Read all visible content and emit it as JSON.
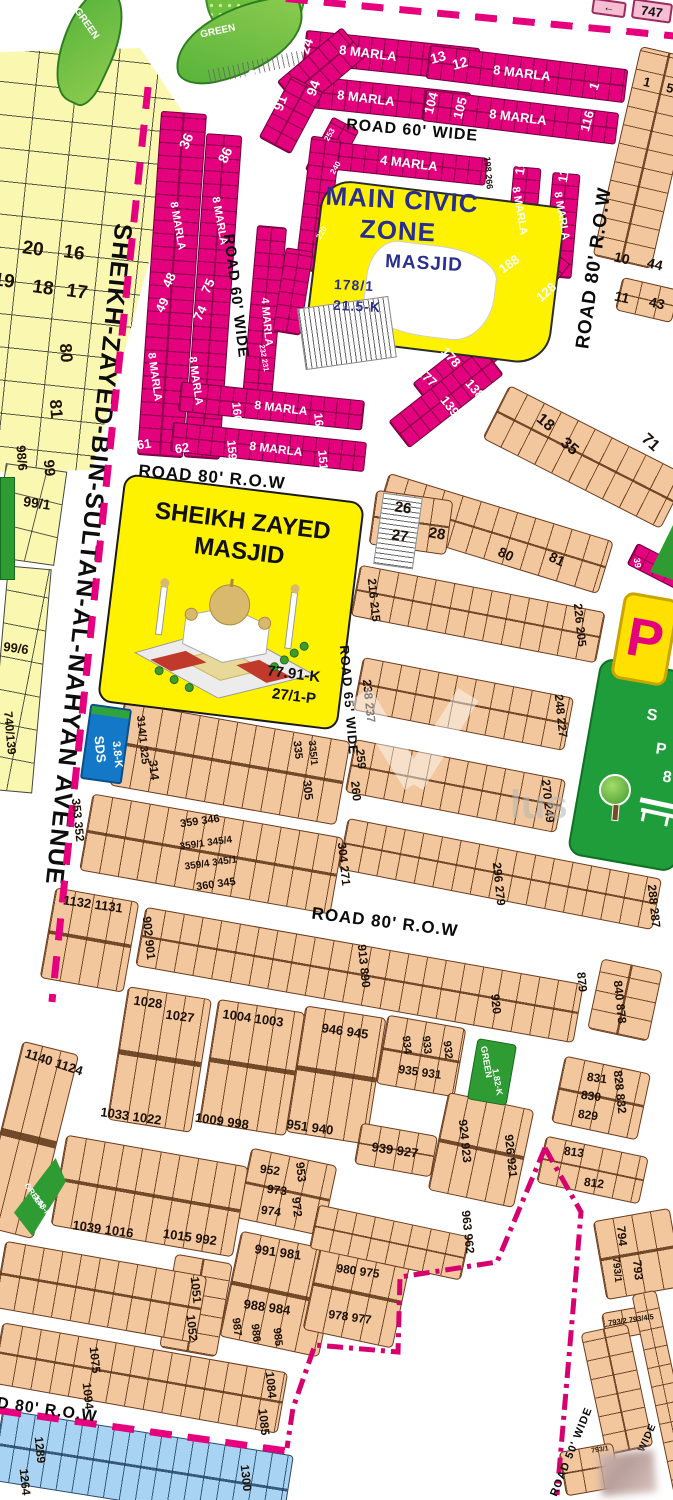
{
  "avenue": {
    "name": "SHEIKH-ZAYED-BIN-SULTAN-AL-NAHYAN AVENUE"
  },
  "civic_zone": {
    "line1": "MAIN CIVIC",
    "line2": "ZONE",
    "line3": "MASJID",
    "plot_no": "178/1",
    "area": "21.5-K"
  },
  "masjid_panel": {
    "line1": "SHEIKH ZAYED",
    "line2": "MASJID",
    "area": "77.91-K",
    "plot_no": "27/1-P"
  },
  "sds_box": {
    "name": "SDS",
    "area": "3.8-K"
  },
  "park": {
    "sign": "P"
  },
  "corner_boxes": {
    "box_747": "747",
    "arrow": "←"
  },
  "watermark": "lus",
  "colors": {
    "magenta": "#E4017D",
    "tan": "#F2C79E",
    "yellow": "#FAF8B0",
    "park_green": "#1F9D3A",
    "blue_strip": "#A9D3F2",
    "dash_pink": "#E6007E",
    "civic_blue": "#2A2F8F",
    "sds_blue": "#1478C8"
  },
  "road_labels": [
    [
      "ROAD 60' WIDE",
      412,
      131,
      5,
      16
    ],
    [
      "ROAD 60' WIDE",
      236,
      296,
      83,
      15
    ],
    [
      "ROAD 80' R.O.W",
      212,
      477,
      5,
      17
    ],
    [
      "ROAD 80' R.O.W",
      594,
      268,
      -82,
      19
    ],
    [
      "ROAD 65' WIDE",
      349,
      700,
      85,
      13
    ],
    [
      "ROAD 80' R.O.W",
      385,
      922,
      7,
      17
    ],
    [
      "ROAD 80' R.O.W",
      28,
      1408,
      8,
      16
    ],
    [
      "ROAD 50' WIDE",
      572,
      1452,
      -68,
      11
    ],
    [
      "WIDE",
      648,
      1438,
      -65,
      10
    ]
  ],
  "plot_labels": [
    [
      "24",
      306,
      46,
      -70,
      14,
      "w"
    ],
    [
      "29",
      252,
      77,
      -70,
      14,
      "w"
    ],
    [
      "30",
      228,
      92,
      -70,
      14,
      "w"
    ],
    [
      "91",
      280,
      103,
      -70,
      14,
      "w"
    ],
    [
      "94",
      313,
      88,
      -70,
      14,
      "w"
    ],
    [
      "13",
      438,
      57,
      -15,
      14,
      "w"
    ],
    [
      "12",
      460,
      63,
      -15,
      14,
      "w"
    ],
    [
      "8 MARLA",
      368,
      53,
      7,
      13,
      "w"
    ],
    [
      "8 MARLA",
      522,
      73,
      7,
      13,
      "w"
    ],
    [
      "8 MARLA",
      366,
      98,
      7,
      13,
      "w"
    ],
    [
      "104",
      431,
      103,
      -75,
      13,
      "w"
    ],
    [
      "105",
      460,
      108,
      -75,
      13,
      "w"
    ],
    [
      "8 MARLA",
      518,
      117,
      7,
      13,
      "w"
    ],
    [
      "1",
      594,
      86,
      -70,
      13,
      "w"
    ],
    [
      "116",
      587,
      121,
      -75,
      13,
      "w"
    ],
    [
      "36",
      186,
      141,
      -65,
      14,
      "w"
    ],
    [
      "86",
      225,
      155,
      -65,
      14,
      "w"
    ],
    [
      "4 MARLA",
      409,
      163,
      7,
      13,
      "w"
    ],
    [
      "197",
      521,
      164,
      -80,
      13,
      "w"
    ],
    [
      "117",
      564,
      172,
      -80,
      13,
      "w"
    ],
    [
      "8 MARLA",
      519,
      211,
      80,
      11,
      "w"
    ],
    [
      "8 MARLA",
      561,
      216,
      80,
      11,
      "w"
    ],
    [
      "8 MARLA",
      177,
      226,
      80,
      11,
      "w"
    ],
    [
      "8 MARLA",
      219,
      221,
      80,
      11,
      "w"
    ],
    [
      "4 MARLA",
      266,
      322,
      85,
      11,
      "w"
    ],
    [
      "48",
      169,
      280,
      -65,
      13,
      "w"
    ],
    [
      "75",
      208,
      286,
      -65,
      13,
      "w"
    ],
    [
      "49",
      162,
      305,
      -65,
      13,
      "w"
    ],
    [
      "74",
      200,
      313,
      -65,
      13,
      "w"
    ],
    [
      "8 MARLA",
      154,
      377,
      82,
      11,
      "w"
    ],
    [
      "8 MARLA",
      195,
      381,
      82,
      11,
      "w"
    ],
    [
      "61",
      144,
      444,
      -8,
      13,
      "w"
    ],
    [
      "62",
      182,
      448,
      -8,
      13,
      "w"
    ],
    [
      "160",
      237,
      412,
      85,
      12,
      "w"
    ],
    [
      "8 MARLA",
      281,
      408,
      7,
      12,
      "w"
    ],
    [
      "167",
      319,
      423,
      85,
      12,
      "w"
    ],
    [
      "159",
      232,
      450,
      85,
      12,
      "w"
    ],
    [
      "8 MARLA",
      276,
      449,
      7,
      12,
      "w"
    ],
    [
      "151",
      323,
      460,
      85,
      12,
      "w"
    ],
    [
      "188",
      509,
      264,
      -35,
      13,
      "w"
    ],
    [
      "128",
      546,
      292,
      -42,
      13,
      "w"
    ],
    [
      "178",
      451,
      357,
      48,
      13,
      "w"
    ],
    [
      "177",
      427,
      377,
      42,
      13,
      "w"
    ],
    [
      "138",
      475,
      389,
      50,
      13,
      "w"
    ],
    [
      "139",
      450,
      406,
      52,
      13,
      "w"
    ],
    [
      "39",
      637,
      563,
      80,
      9,
      "w"
    ],
    [
      "253",
      330,
      135,
      -60,
      8,
      "w"
    ],
    [
      "240",
      336,
      168,
      -60,
      8,
      "w"
    ],
    [
      "220",
      322,
      233,
      -60,
      8,
      "w"
    ],
    [
      "232 231",
      264,
      358,
      80,
      7.5,
      "w"
    ],
    [
      "198 266",
      488,
      173,
      85,
      9,
      "k"
    ],
    [
      "20",
      33,
      249,
      8,
      19,
      "k"
    ],
    [
      "16",
      74,
      253,
      8,
      19,
      "k"
    ],
    [
      "19",
      4,
      281,
      8,
      19,
      "k"
    ],
    [
      "18",
      43,
      288,
      8,
      19,
      "k"
    ],
    [
      "17",
      77,
      292,
      8,
      19,
      "k"
    ],
    [
      "80",
      66,
      353,
      85,
      17,
      "k"
    ],
    [
      "81",
      56,
      409,
      85,
      17,
      "k"
    ],
    [
      "98/6",
      22,
      458,
      85,
      13,
      "k"
    ],
    [
      "99",
      49,
      468,
      85,
      15,
      "k"
    ],
    [
      "99/1",
      37,
      503,
      8,
      14,
      "k"
    ],
    [
      "99/6",
      16,
      648,
      8,
      13,
      "k"
    ],
    [
      "740/139",
      10,
      733,
      85,
      12,
      "k"
    ],
    [
      "1",
      647,
      82,
      13,
      13,
      "k"
    ],
    [
      "5",
      670,
      88,
      13,
      13,
      "k"
    ],
    [
      "10",
      622,
      258,
      13,
      14,
      "k"
    ],
    [
      "44",
      655,
      264,
      13,
      14,
      "k"
    ],
    [
      "11",
      622,
      297,
      13,
      14,
      "k"
    ],
    [
      "43",
      657,
      303,
      13,
      14,
      "k"
    ],
    [
      "18",
      545,
      423,
      40,
      16,
      "k"
    ],
    [
      "35",
      569,
      447,
      40,
      16,
      "k"
    ],
    [
      "71",
      650,
      443,
      42,
      16,
      "k"
    ],
    [
      "26",
      403,
      508,
      8,
      15,
      "k"
    ],
    [
      "27",
      400,
      536,
      8,
      15,
      "k"
    ],
    [
      "28",
      437,
      534,
      10,
      15,
      "k"
    ],
    [
      "80",
      506,
      554,
      25,
      14,
      "k"
    ],
    [
      "81",
      557,
      559,
      25,
      14,
      "k"
    ],
    [
      "216 215",
      374,
      600,
      84,
      12,
      "k"
    ],
    [
      "226 205",
      580,
      625,
      84,
      12,
      "k"
    ],
    [
      "238 237",
      369,
      701,
      84,
      12,
      "k"
    ],
    [
      "248 227",
      561,
      716,
      84,
      12,
      "k"
    ],
    [
      "259",
      361,
      759,
      84,
      12,
      "k"
    ],
    [
      "260",
      356,
      791,
      84,
      12,
      "k"
    ],
    [
      "270 249",
      548,
      801,
      84,
      12,
      "k"
    ],
    [
      "296 279",
      499,
      884,
      84,
      12,
      "k"
    ],
    [
      "288 287",
      654,
      906,
      84,
      12,
      "k"
    ],
    [
      "304 271",
      344,
      864,
      84,
      12,
      "k"
    ],
    [
      "335",
      297,
      750,
      84,
      11,
      "k"
    ],
    [
      "335/1",
      312,
      753,
      84,
      10,
      "k"
    ],
    [
      "305",
      308,
      790,
      84,
      12,
      "k"
    ],
    [
      "314/1 325",
      142,
      740,
      84,
      11,
      "k"
    ],
    [
      "314",
      154,
      770,
      84,
      12,
      "k"
    ],
    [
      "353 352",
      78,
      820,
      84,
      12,
      "k"
    ],
    [
      "359 346",
      200,
      822,
      -8,
      11,
      "k"
    ],
    [
      "359/1 345/4",
      206,
      844,
      -8,
      10,
      "k"
    ],
    [
      "359/4 345/1",
      211,
      864,
      -8,
      10,
      "k"
    ],
    [
      "360 345",
      216,
      885,
      -8,
      11,
      "k"
    ],
    [
      "1132 1131",
      93,
      904,
      8,
      13,
      "k"
    ],
    [
      "902 901",
      149,
      938,
      84,
      12,
      "k"
    ],
    [
      "913 890",
      364,
      966,
      84,
      12,
      "k"
    ],
    [
      "920",
      496,
      1004,
      84,
      12,
      "k"
    ],
    [
      "879",
      582,
      982,
      84,
      12,
      "k"
    ],
    [
      "840 878",
      620,
      1002,
      84,
      12,
      "k"
    ],
    [
      "1028",
      148,
      1002,
      8,
      13,
      "k"
    ],
    [
      "1027",
      180,
      1016,
      8,
      13,
      "k"
    ],
    [
      "1004 1003",
      253,
      1018,
      8,
      13,
      "k"
    ],
    [
      "946 945",
      345,
      1031,
      8,
      13,
      "k"
    ],
    [
      "1140 1124",
      54,
      1062,
      18,
      13,
      "k"
    ],
    [
      "1033 1022",
      131,
      1116,
      8,
      13,
      "k"
    ],
    [
      "1009 998",
      222,
      1121,
      8,
      13,
      "k"
    ],
    [
      "951 940",
      310,
      1127,
      8,
      13,
      "k"
    ],
    [
      "934",
      406,
      1045,
      84,
      11,
      "k"
    ],
    [
      "933",
      426,
      1045,
      84,
      11,
      "k"
    ],
    [
      "932",
      447,
      1050,
      84,
      11,
      "k"
    ],
    [
      "935 931",
      420,
      1072,
      8,
      12,
      "k"
    ],
    [
      "939 927",
      395,
      1150,
      8,
      13,
      "k"
    ],
    [
      "924 923",
      465,
      1141,
      84,
      12,
      "k"
    ],
    [
      "926 921",
      511,
      1156,
      84,
      12,
      "k"
    ],
    [
      "831",
      597,
      1078,
      8,
      12,
      "k"
    ],
    [
      "830",
      591,
      1096,
      8,
      12,
      "k"
    ],
    [
      "829",
      588,
      1115,
      8,
      12,
      "k"
    ],
    [
      "828 832",
      620,
      1092,
      84,
      12,
      "k"
    ],
    [
      "813",
      574,
      1152,
      8,
      12,
      "k"
    ],
    [
      "812",
      594,
      1183,
      8,
      12,
      "k"
    ],
    [
      "952",
      270,
      1170,
      8,
      12,
      "k"
    ],
    [
      "953",
      301,
      1172,
      84,
      12,
      "k"
    ],
    [
      "973",
      277,
      1190,
      8,
      12,
      "k"
    ],
    [
      "972",
      297,
      1207,
      84,
      12,
      "k"
    ],
    [
      "974",
      271,
      1211,
      8,
      12,
      "k"
    ],
    [
      "963 962",
      468,
      1232,
      84,
      12,
      "k"
    ],
    [
      "1039 1016",
      103,
      1229,
      8,
      13,
      "k"
    ],
    [
      "1015 992",
      190,
      1237,
      8,
      13,
      "k"
    ],
    [
      "991 981",
      278,
      1252,
      8,
      13,
      "k"
    ],
    [
      "988 984",
      267,
      1307,
      8,
      13,
      "k"
    ],
    [
      "987",
      236,
      1327,
      84,
      11,
      "k"
    ],
    [
      "986",
      255,
      1333,
      84,
      11,
      "k"
    ],
    [
      "985",
      277,
      1337,
      84,
      11,
      "k"
    ],
    [
      "980 975",
      358,
      1271,
      8,
      12,
      "k"
    ],
    [
      "978 977",
      350,
      1317,
      8,
      12,
      "k"
    ],
    [
      "1051",
      196,
      1290,
      84,
      12,
      "k"
    ],
    [
      "1052",
      192,
      1328,
      84,
      12,
      "k"
    ],
    [
      "1075",
      95,
      1360,
      84,
      12,
      "k"
    ],
    [
      "1094",
      88,
      1396,
      84,
      12,
      "k"
    ],
    [
      "1084",
      271,
      1385,
      84,
      12,
      "k"
    ],
    [
      "1085",
      264,
      1422,
      84,
      12,
      "k"
    ],
    [
      "1289",
      40,
      1450,
      84,
      12,
      "k"
    ],
    [
      "1264",
      25,
      1482,
      84,
      12,
      "k"
    ],
    [
      "1300",
      246,
      1478,
      84,
      12,
      "k"
    ],
    [
      "794",
      622,
      1236,
      84,
      12,
      "k"
    ],
    [
      "793/1",
      616,
      1270,
      84,
      10,
      "k"
    ],
    [
      "793",
      638,
      1270,
      84,
      12,
      "k"
    ],
    [
      "793/2 793/4/5",
      631,
      1320,
      -8,
      7.5,
      "k"
    ],
    [
      "793/1",
      600,
      1450,
      -8,
      7,
      "k"
    ],
    [
      "GREEN",
      86,
      24,
      55,
      10,
      "w"
    ],
    [
      "GREEN",
      218,
      32,
      -12,
      10,
      "w"
    ],
    [
      "GREEN",
      486,
      1062,
      80,
      9,
      "w"
    ],
    [
      "1.82-K",
      497,
      1082,
      80,
      9,
      "w"
    ],
    [
      "GREEN",
      34,
      1196,
      55,
      8,
      "w"
    ],
    [
      "1.68-K",
      42,
      1206,
      55,
      8,
      "w"
    ],
    [
      "S",
      652,
      716,
      8,
      16,
      "w"
    ],
    [
      "P",
      661,
      750,
      8,
      16,
      "w"
    ],
    [
      "8",
      667,
      778,
      8,
      16,
      "w"
    ]
  ]
}
